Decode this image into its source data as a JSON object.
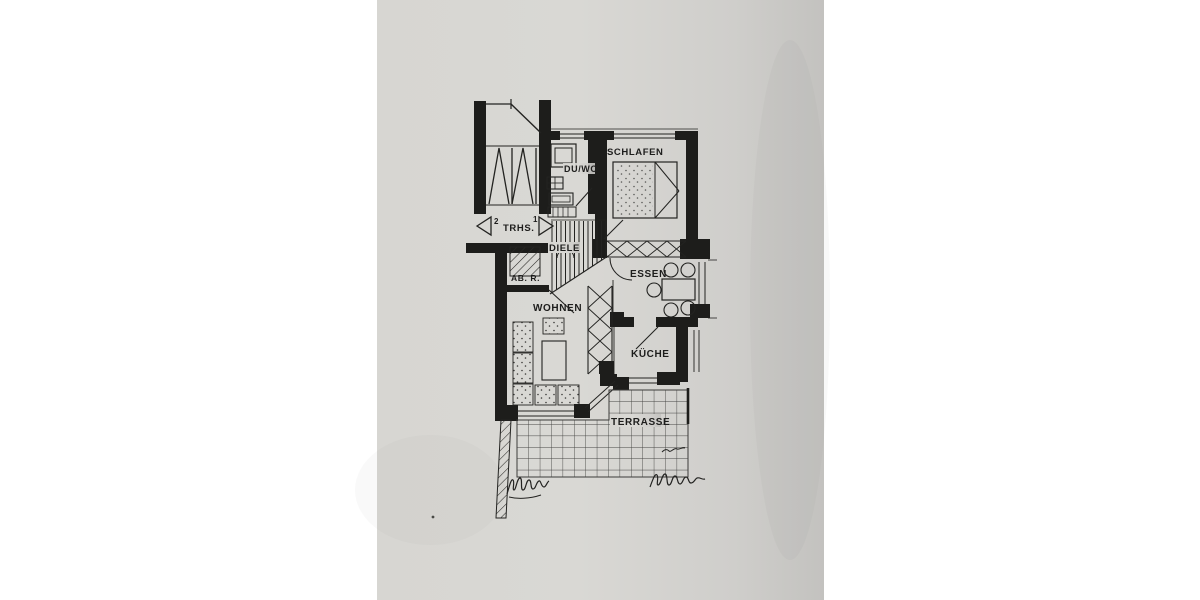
{
  "plan": {
    "rooms": {
      "schlafen": "SCHLAFEN",
      "duwc": "DU/WC",
      "diele": "DIELE",
      "abstellraum": "AB. R.",
      "wohnen": "WOHNEN",
      "essen": "ESSEN",
      "kueche": "KÜCHE",
      "terrasse": "TERRASSE"
    },
    "staircase": {
      "left_number": "2",
      "label": "TRHS.",
      "right_number": "1"
    },
    "colors": {
      "paper": "#d5d4d0",
      "ink": "#1d1d1c",
      "margin": "#ffffff"
    }
  }
}
